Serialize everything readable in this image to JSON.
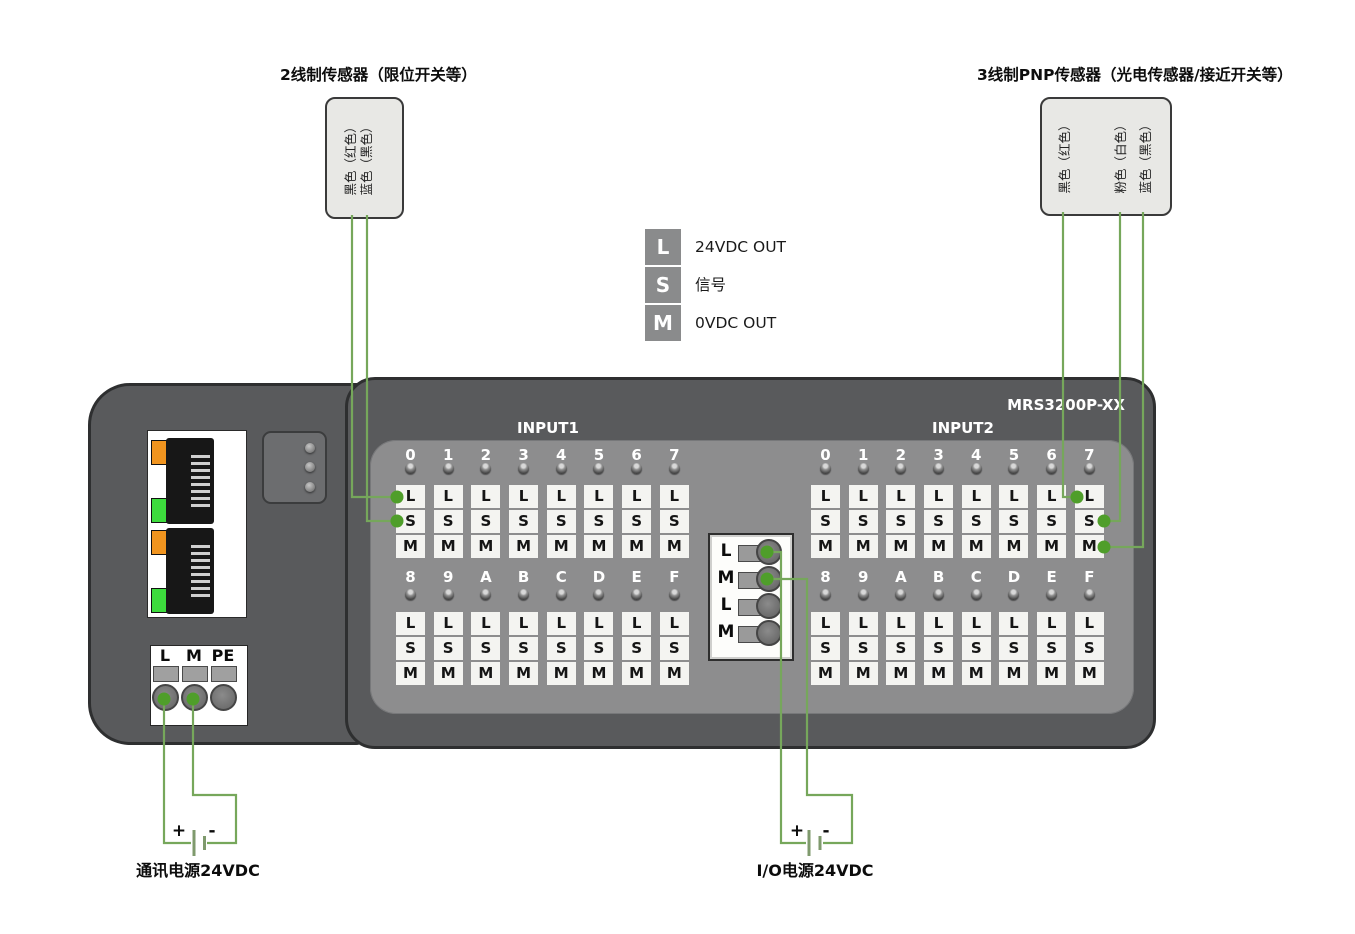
{
  "sensors": {
    "two_wire": {
      "title": "2线制传感器（限位开关等）",
      "wires": [
        "黑色（红色）",
        "蓝色（黑色）"
      ]
    },
    "three_wire": {
      "title": "3线制PNP传感器（光电传感器/接近开关等）",
      "wires": [
        "黑色（红色）",
        "粉色（白色）",
        "蓝色（黑色）"
      ]
    }
  },
  "legend": [
    {
      "key": "L",
      "label": "24VDC OUT"
    },
    {
      "key": "S",
      "label": "信号"
    },
    {
      "key": "M",
      "label": "0VDC OUT"
    }
  ],
  "device": {
    "model": "MRS3200P-XX",
    "comm_terminal": [
      "L",
      "M",
      "PE"
    ],
    "io_terminal": [
      "L",
      "M",
      "L",
      "M"
    ],
    "channel_pins": [
      "L",
      "S",
      "M"
    ],
    "groups": [
      {
        "name": "INPUT1",
        "rows": [
          [
            "0",
            "1",
            "2",
            "3",
            "4",
            "5",
            "6",
            "7"
          ],
          [
            "8",
            "9",
            "A",
            "B",
            "C",
            "D",
            "E",
            "F"
          ]
        ]
      },
      {
        "name": "INPUT2",
        "rows": [
          [
            "0",
            "1",
            "2",
            "3",
            "4",
            "5",
            "6",
            "7"
          ],
          [
            "8",
            "9",
            "A",
            "B",
            "C",
            "D",
            "E",
            "F"
          ]
        ]
      }
    ]
  },
  "power": {
    "comm": {
      "label": "通讯电源24VDC",
      "plus": "+",
      "minus": "-"
    },
    "io": {
      "label": "I/O电源24VDC",
      "plus": "+",
      "minus": "-"
    }
  },
  "colors": {
    "wire": "#76a75b",
    "dot": "#4f9e2a",
    "led_orange": "#f0941f",
    "led_green": "#3ddc3d",
    "body": "#595a5c",
    "panel": "#8d8d8e"
  }
}
